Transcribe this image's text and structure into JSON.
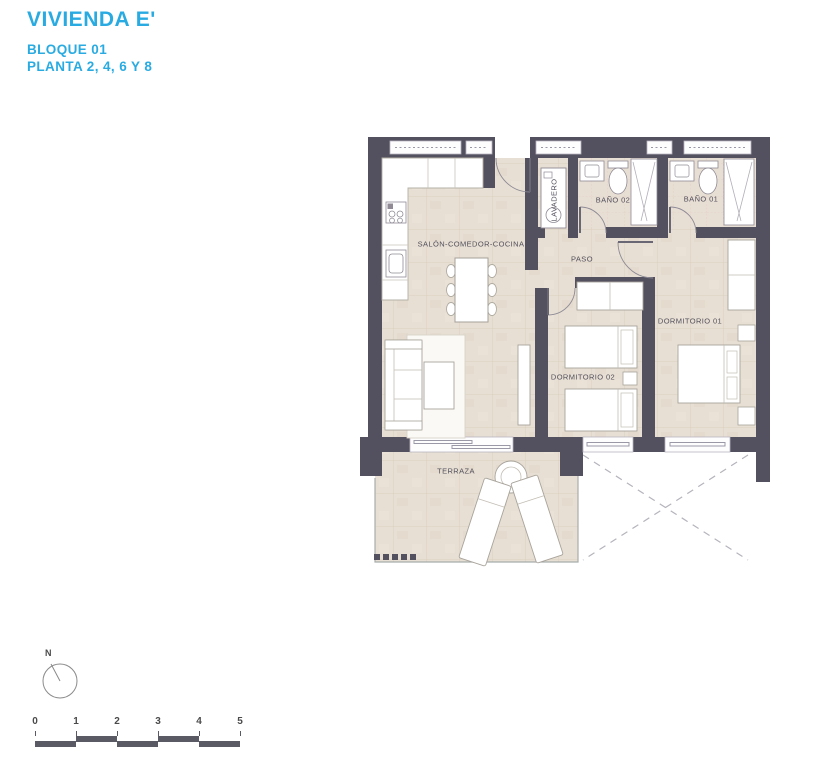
{
  "header": {
    "title": "VIVIENDA E'",
    "subtitle_block": "BLOQUE 01",
    "subtitle_floors": "PLANTA 2, 4, 6 Y 8"
  },
  "plan": {
    "rooms": {
      "salon": "SALÓN-COMEDOR-COCINA",
      "lavadero": "LAVADERO",
      "bano02": "BAÑO 02",
      "bano01": "BAÑO 01",
      "paso": "PASO",
      "dormitorio01": "DORMITORIO 01",
      "dormitorio02": "DORMITORIO 02",
      "terraza": "TERRAZA"
    }
  },
  "compass": {
    "north_label": "N"
  },
  "scale_bar": {
    "ticks": [
      "0",
      "1",
      "2",
      "3",
      "4",
      "5"
    ]
  },
  "colors": {
    "accent_blue": "#29abe2",
    "wall": "#53505f",
    "floor": "#e7dfd3",
    "label_text": "#524f5c"
  }
}
